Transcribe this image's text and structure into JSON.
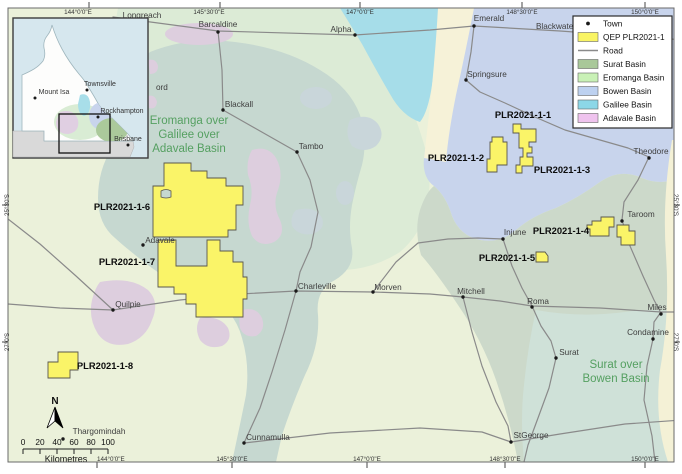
{
  "legend": {
    "items": [
      {
        "label": "Town",
        "type": "dot",
        "color": "#1a1a1a"
      },
      {
        "label": "QEP PLR2021-1",
        "type": "swatch",
        "color": "#f9f463"
      },
      {
        "label": "Road",
        "type": "line",
        "color": "#8a8a8a"
      },
      {
        "label": "Surat Basin",
        "type": "swatch",
        "color": "#a9c899"
      },
      {
        "label": "Eromanga Basin",
        "type": "swatch",
        "color": "#c9f1b6"
      },
      {
        "label": "Bowen Basin",
        "type": "swatch",
        "color": "#bdd1f0"
      },
      {
        "label": "Galilee Basin",
        "type": "swatch",
        "color": "#8cd7e7"
      },
      {
        "label": "Adavale Basin",
        "type": "swatch",
        "color": "#efc3ee"
      }
    ]
  },
  "towns": [
    {
      "name": "Longreach"
    },
    {
      "name": "Barcaldine"
    },
    {
      "name": "Alpha"
    },
    {
      "name": "Emerald"
    },
    {
      "name": "Blackwater"
    },
    {
      "name": "Springsure"
    },
    {
      "name": "Theodore"
    },
    {
      "name": "Blackall"
    },
    {
      "name": "Tambo"
    },
    {
      "name": "Taroom"
    },
    {
      "name": "Injune"
    },
    {
      "name": "Adavale"
    },
    {
      "name": "Charleville"
    },
    {
      "name": "Morven"
    },
    {
      "name": "Mitchell"
    },
    {
      "name": "Roma"
    },
    {
      "name": "Miles"
    },
    {
      "name": "Condamine"
    },
    {
      "name": "Surat"
    },
    {
      "name": "Quilpie"
    },
    {
      "name": "Thargomindah"
    },
    {
      "name": "Cunnamulla"
    },
    {
      "name": "StGeorge"
    },
    {
      "name": "ord"
    }
  ],
  "inset": {
    "towns": [
      {
        "name": "Townsville"
      },
      {
        "name": "Mount Isa"
      },
      {
        "name": "Rockhampton"
      },
      {
        "name": "Brisbane"
      }
    ]
  },
  "plr_labels": [
    {
      "text": "PLR2021-1-1"
    },
    {
      "text": "PLR2021-1-2"
    },
    {
      "text": "PLR2021-1-3"
    },
    {
      "text": "PLR2021-1-4"
    },
    {
      "text": "PLR2021-1-5"
    },
    {
      "text": "PLR2021-1-6"
    },
    {
      "text": "PLR2021-1-7"
    },
    {
      "text": "PLR2021-1-8"
    }
  ],
  "region_labels": {
    "eromanga_line1": "Eromanga over",
    "eromanga_line2": "Galilee over",
    "eromanga_line3": "Adavale Basin",
    "surat_line1": "Surat over",
    "surat_line2": "Bowen Basin"
  },
  "coordinates": {
    "top": [
      {
        "text": "144°0'0\"E"
      },
      {
        "text": "145°30'0\"E"
      },
      {
        "text": "147°0'0\"E"
      },
      {
        "text": "148°30'0\"E"
      },
      {
        "text": "150°0'0\"E"
      }
    ],
    "bottom": [
      {
        "text": "144°0'0\"E"
      },
      {
        "text": "145°30'0\"E"
      },
      {
        "text": "147°0'0\"E"
      },
      {
        "text": "148°30'0\"E"
      },
      {
        "text": "150°0'0\"E"
      }
    ],
    "left": [
      {
        "text": "25°30'S"
      },
      {
        "text": "27°0'S"
      }
    ],
    "right": [
      {
        "text": "25°30'S"
      },
      {
        "text": "27°0'S"
      }
    ]
  },
  "scalebar": {
    "ticks": [
      {
        "v": "0"
      },
      {
        "v": "20"
      },
      {
        "v": "40"
      },
      {
        "v": "60"
      },
      {
        "v": "80"
      },
      {
        "v": "100"
      }
    ],
    "unit": "Kilometres"
  },
  "north_label": "N",
  "colors": {
    "plr_fill": "#faf468",
    "road": "#8a8a8a",
    "bowen_region": "#c8d4ec",
    "galilee_region": "#a6dde9",
    "adavale_region": "#ddcede",
    "central_overlap_region": "#c6d8d0",
    "surat_region": "#ccd9ca",
    "base_land": "#ebf1da"
  }
}
